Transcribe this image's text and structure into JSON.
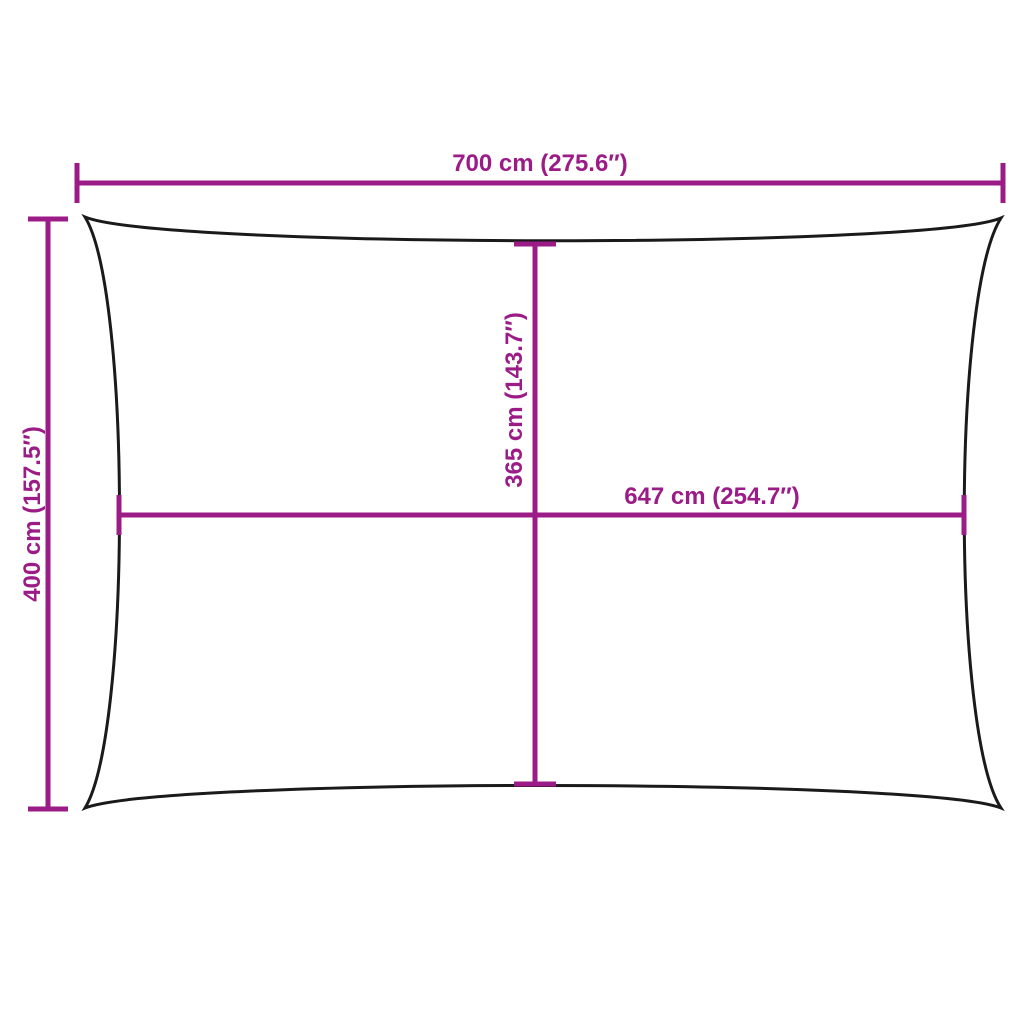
{
  "colors": {
    "dimension": "#9B1B87",
    "outline": "#1A1A1A",
    "background": "#FFFFFF"
  },
  "dimensions": {
    "overall_width": {
      "label": "700 cm (275.6″)",
      "cm": 700,
      "inches": 275.6
    },
    "overall_height": {
      "label": "400 cm (157.5″)",
      "cm": 400,
      "inches": 157.5
    },
    "center_height": {
      "label": "365 cm (143.7″)",
      "cm": 365,
      "inches": 143.7
    },
    "center_width": {
      "label": "647 cm (254.7″)",
      "cm": 647,
      "inches": 254.7
    }
  }
}
